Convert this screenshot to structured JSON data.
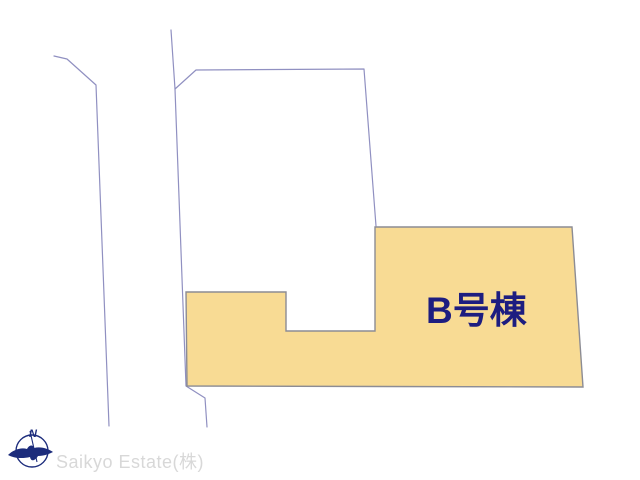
{
  "plan": {
    "lot_label": "B号棟"
  },
  "compass": {
    "north_label": "N"
  },
  "watermark": {
    "text": "Saikyo Estate(株)"
  },
  "theme": {
    "background": "#ffffff",
    "accent_fill": "#f8db94",
    "accent_border": "#8c8c94",
    "boundary_line": "#9090c1",
    "label_text": "#1d1d80",
    "compass": "#1c2c7c",
    "watermark_text": "#d8d8d8"
  }
}
